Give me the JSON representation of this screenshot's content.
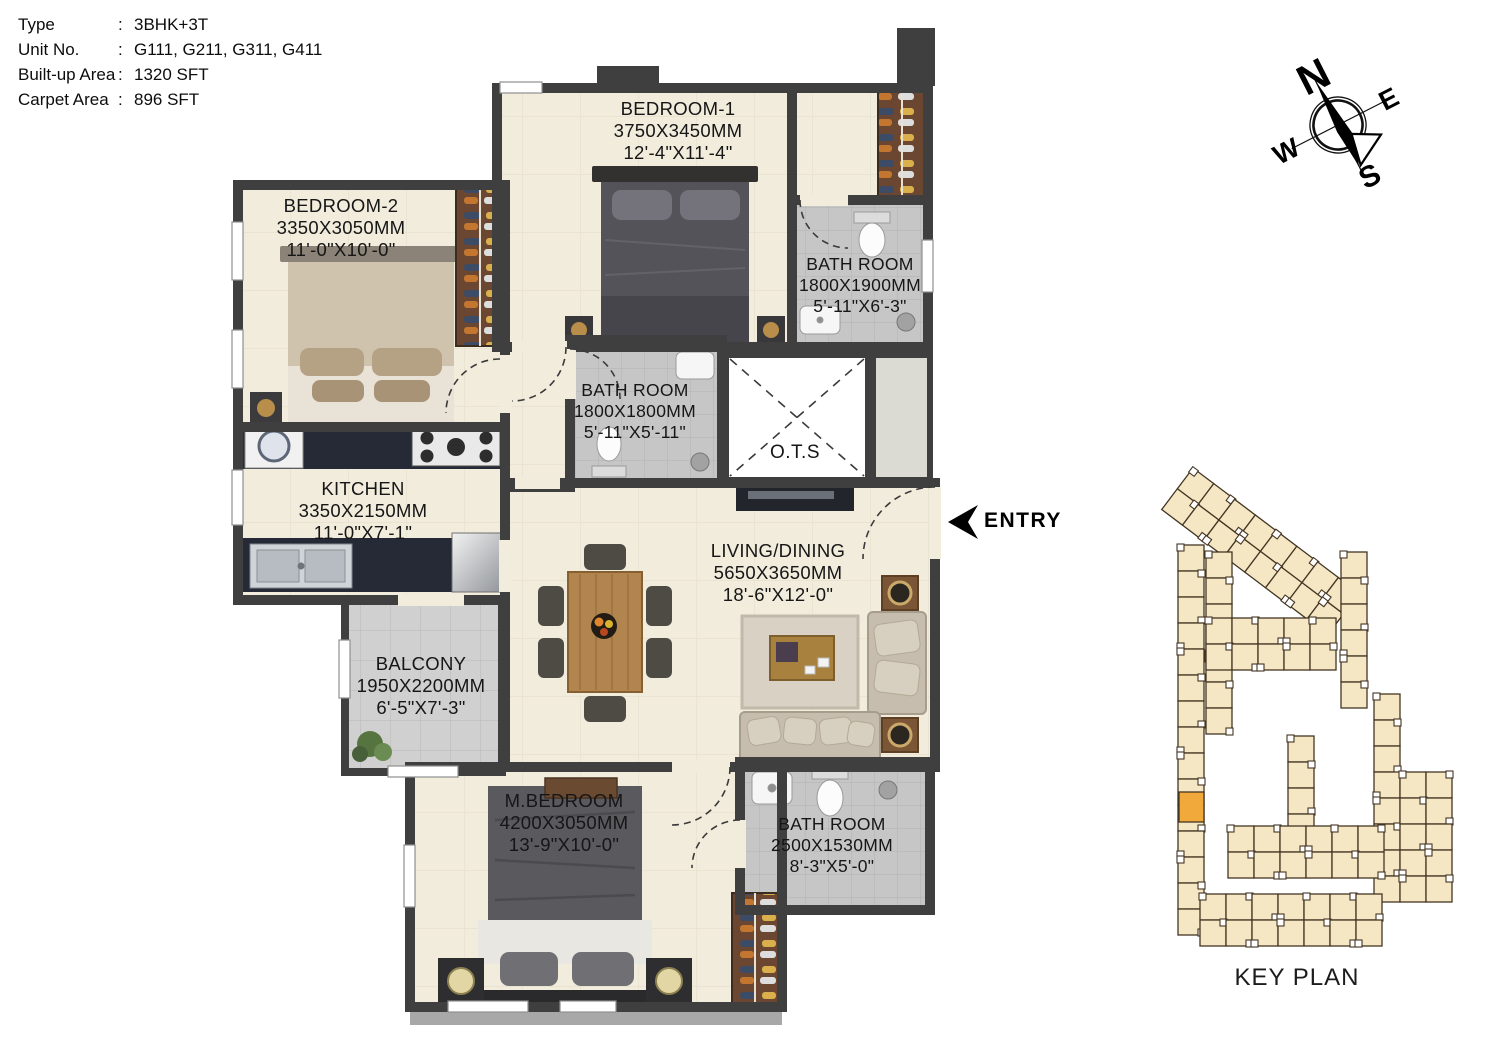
{
  "info": {
    "colon": ":",
    "rows": [
      {
        "label": "Type",
        "value": "3BHK+3T"
      },
      {
        "label": "Unit No.",
        "value": "G111, G211, G311, G411"
      },
      {
        "label": "Built-up Area",
        "value": "1320 SFT"
      },
      {
        "label": "Carpet Area",
        "value": "896 SFT"
      }
    ]
  },
  "plan": {
    "rooms": [
      {
        "name": "BEDROOM-1",
        "dim_mm": "3750X3450MM",
        "dim_ft": "12'-4\"X11'-4\""
      },
      {
        "name": "BEDROOM-2",
        "dim_mm": "3350X3050MM",
        "dim_ft": "11'-0\"X10'-0\""
      },
      {
        "name": "BATH ROOM",
        "dim_mm": "1800X1900MM",
        "dim_ft": "5'-11\"X6'-3\""
      },
      {
        "name": "BATH ROOM",
        "dim_mm": "1800X1800MM",
        "dim_ft": "5'-11\"X5'-11\""
      },
      {
        "name": "O.T.S"
      },
      {
        "name": "KITCHEN",
        "dim_mm": "3350X2150MM",
        "dim_ft": "11'-0\"X7'-1\""
      },
      {
        "name": "LIVING/DINING",
        "dim_mm": "5650X3650MM",
        "dim_ft": "18'-6\"X12'-0\""
      },
      {
        "name": "BALCONY",
        "dim_mm": "1950X2200MM",
        "dim_ft": "6'-5\"X7'-3\""
      },
      {
        "name": "M.BEDROOM",
        "dim_mm": "4200X3050MM",
        "dim_ft": "13'-9\"X10'-0\""
      },
      {
        "name": "BATH ROOM",
        "dim_mm": "2500X1530MM",
        "dim_ft": "8'-3\"X5'-0\""
      }
    ],
    "entry_label": "ENTRY"
  },
  "compass": {
    "n": "N",
    "e": "E",
    "s": "S",
    "w": "W"
  },
  "key_plan": {
    "title": "KEY PLAN",
    "building_color": "#f5e7c4",
    "building_outline": "#433523",
    "highlight_color": "#f2a93b"
  },
  "colors": {
    "wall": "#3f3f3f",
    "floor": "#f2ecdd",
    "bath_tile": "#c6c6c6",
    "balcony_tile": "#d0d0d0",
    "counter": "#262a36",
    "wood": "#b3854e",
    "wardrobe_wood": "#6b4732",
    "sofa": "#c6bdae"
  }
}
